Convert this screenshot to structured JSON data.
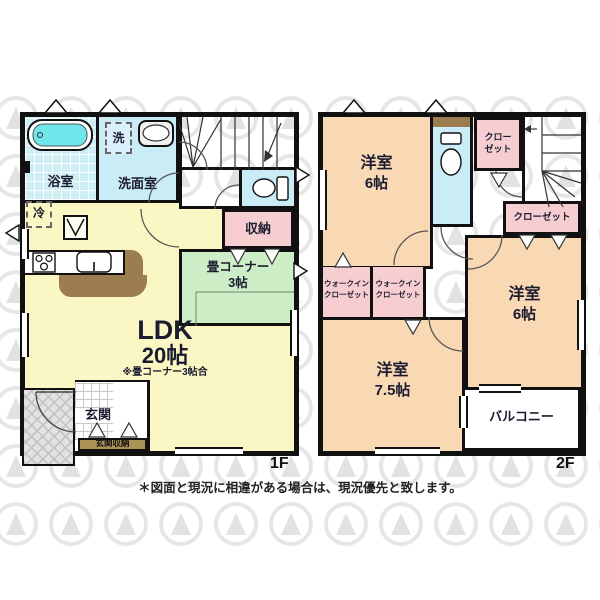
{
  "note": "＊図面と現況に相違がある場合は、現況優先と致します。",
  "floors": {
    "f1": {
      "label": "1F",
      "bath": "浴室",
      "washer": "洗",
      "washroom": "洗面室",
      "storage": "収納",
      "tatami_line1": "畳コーナー",
      "tatami_line2": "3帖",
      "ldk_line1": "LDK",
      "ldk_line2": "20帖",
      "ldk_note": "※畳コーナー3帖合",
      "fridge": "冷",
      "genkan": "玄関",
      "genkan_storage": "玄関収納"
    },
    "f2": {
      "label": "2F",
      "room6a_line1": "洋室",
      "room6a_line2": "6帖",
      "closet_small_line1": "クロー",
      "closet_small_line2": "ゼット",
      "closet": "クローゼット",
      "room6b_line1": "洋室",
      "room6b_line2": "6帖",
      "wic1_line1": "ウォークイン",
      "wic1_line2": "クローゼット",
      "wic2_line1": "ウォークイン",
      "wic2_line2": "クローゼット",
      "room75_line1": "洋室",
      "room75_line2": "7.5帖",
      "balcony": "バルコニー"
    }
  },
  "colors": {
    "wall": "#111111",
    "ldk_yellow": "#fbf7c4",
    "tatami_green": "#cdedc6",
    "closet_pink": "#f6ced2",
    "room_peach": "#f8d9b4",
    "wet_blue": "#c9ecf6",
    "bathtub_cyan": "#6fe6ea",
    "counter_brown": "#9b7d50",
    "genkan_storage_tan": "#ab9355",
    "porch_gray": "#e2e2e2",
    "watermark_gray": "#d2d2d2"
  }
}
